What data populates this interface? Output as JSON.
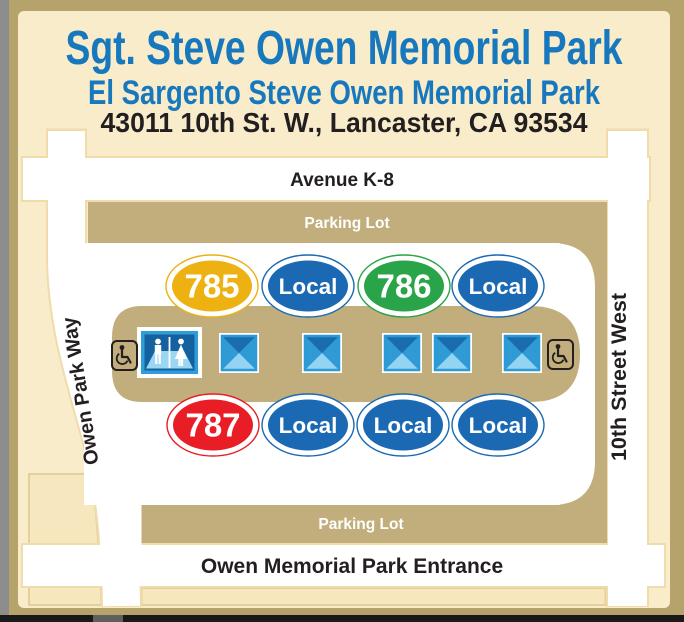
{
  "header": {
    "title": "Sgt. Steve Owen Memorial Park",
    "subtitle": "El Sargento Steve Owen Memorial Park",
    "address": "43011 10th St. W., Lancaster, CA 93534"
  },
  "streets": {
    "north": "Avenue K-8",
    "west": "Owen Park Way",
    "east": "10th Street West",
    "south": "Owen Memorial Park Entrance"
  },
  "parking": {
    "top_label": "Parking Lot",
    "bottom_label": "Parking Lot"
  },
  "bays": {
    "top": [
      {
        "label": "785",
        "color": "#edb111",
        "type": "route"
      },
      {
        "label": "Local",
        "color": "#1a69b2",
        "type": "local"
      },
      {
        "label": "786",
        "color": "#2aa449",
        "type": "route"
      },
      {
        "label": "Local",
        "color": "#1a69b2",
        "type": "local"
      }
    ],
    "bottom": [
      {
        "label": "787",
        "color": "#e91d25",
        "type": "route"
      },
      {
        "label": "Local",
        "color": "#1a69b2",
        "type": "local"
      },
      {
        "label": "Local",
        "color": "#1a69b2",
        "type": "local"
      },
      {
        "label": "Local",
        "color": "#1a69b2",
        "type": "local"
      }
    ]
  },
  "icons": {
    "restroom": "restroom",
    "shelter": "shade-shelter",
    "shelter_count": 5,
    "accessible": "wheelchair-accessible"
  },
  "colors": {
    "background_gold": "#b5a36b",
    "card_cream": "#f8ecca",
    "road_white": "#ffffff",
    "road_outline": "#f0dcaa",
    "parking_tan": "#c1ae7c",
    "parcel_cream": "#f6e7bf",
    "parcel_outline": "#e5cf9c",
    "title_blue": "#1778be",
    "text_black": "#231f20",
    "route_785": "#edb111",
    "route_786": "#2aa449",
    "route_787": "#e91d25",
    "local_blue": "#1a69b2"
  }
}
